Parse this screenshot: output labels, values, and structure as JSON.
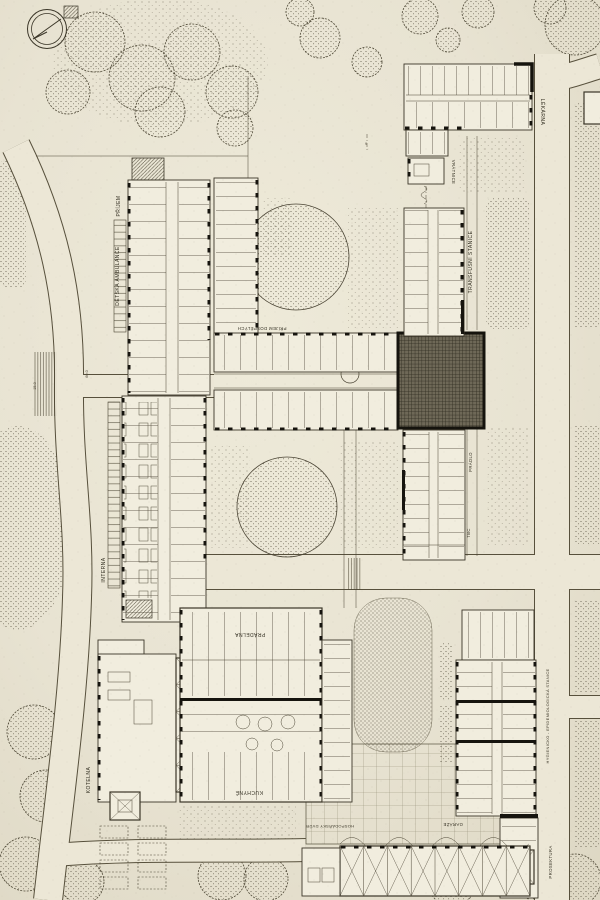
{
  "drawing": {
    "type": "hospital-site-plan",
    "palette": {
      "paper": "#e8e3d2",
      "ink": "#3b372b",
      "heavy_wall": "#16140e",
      "road_fill": "#ece7d6"
    },
    "labels": {
      "prijem": "PŘÍJEM",
      "detska_ambulance": "DĚTSKÁ AMBULANCE",
      "interna": "INTERNA",
      "prijem_dospelych": "PŘÍJEM DOSPĚLÝCH",
      "lekarna": "LÉKÁRNA",
      "vratnice": "VRÁTNICE",
      "transfusni_stanice": "TRANSFUSNÍ STANICE",
      "pradlo": "PRÁDLO",
      "tbc": "TBC",
      "kotelna": "KOTELNA",
      "pradelna": "PRÁDELNA",
      "kuchyne": "KUCHYNĚ",
      "hospodarsky_dvur": "HOSPODÁŘSKÝ DVŮR",
      "garaze": "GARÁŽE",
      "prosektura": "PROSEKTURA",
      "hygienicka_stanice": "HYGIENICKO - EPIDEMIOLOGICKÁ STANICE"
    },
    "dimensions": {
      "d60": "60.0",
      "d15": "15.0",
      "d9": "9"
    }
  }
}
